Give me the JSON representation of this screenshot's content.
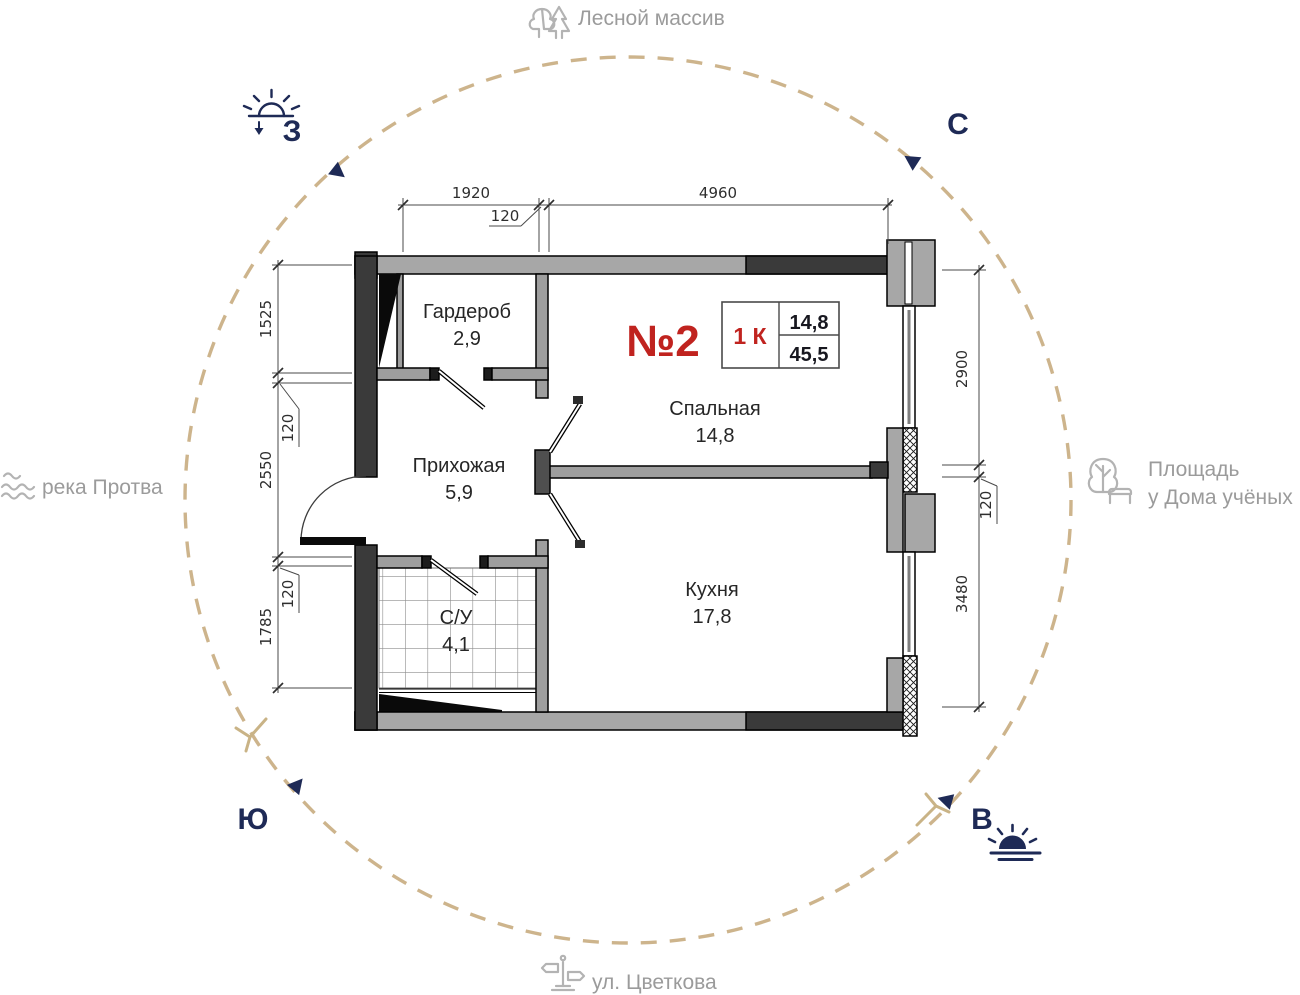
{
  "map_labels": {
    "forest": "Лесной массив",
    "river": "река Протва",
    "square_line1": "Площадь",
    "square_line2": "у Дома учёных",
    "street": "ул. Цветкова"
  },
  "compass": {
    "north": "С",
    "west": "З",
    "south": "Ю",
    "east": "В"
  },
  "apartment": {
    "number": "№2",
    "type": "1 К",
    "area_living": "14,8",
    "area_total": "45,5"
  },
  "rooms": [
    {
      "name": "Гардероб",
      "area": "2,9"
    },
    {
      "name": "Спальная",
      "area": "14,8"
    },
    {
      "name": "Прихожая",
      "area": "5,9"
    },
    {
      "name": "С/У",
      "area": "4,1"
    },
    {
      "name": "Кухня",
      "area": "17,8"
    }
  ],
  "dimensions": {
    "top": [
      "1920",
      "120",
      "4960"
    ],
    "left": [
      "1525",
      "120",
      "2550",
      "120",
      "1785"
    ],
    "right": [
      "2900",
      "120",
      "3480"
    ]
  },
  "icons": {
    "forest": "trees-icon",
    "river": "waves-icon",
    "square": "tree-bench-icon",
    "street": "signpost-icon",
    "west": "sunset-icon",
    "east": "sunrise-icon"
  },
  "colors": {
    "navy": "#1e2a56",
    "tan": "#cdb48c",
    "red": "#c0231f",
    "label_gray": "#9b9b9b",
    "wall_dark": "#3a3a3a",
    "wall_gray": "#a7a7a7"
  }
}
